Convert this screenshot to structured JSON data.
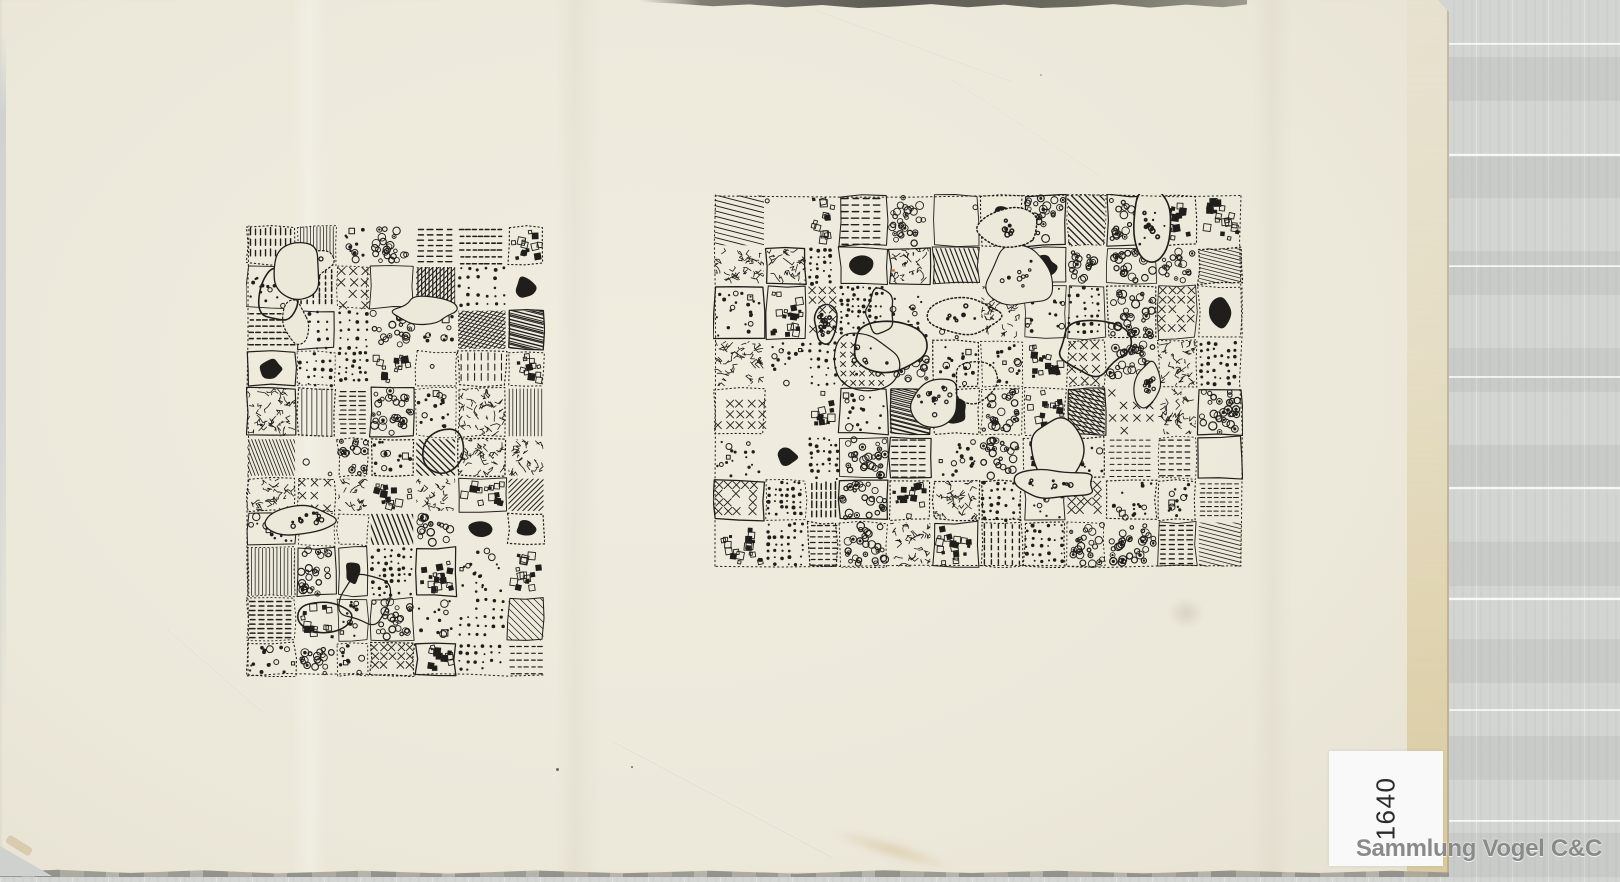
{
  "scan": {
    "background_color": "#d3d5d3",
    "background_band_light": "#e0e1e0",
    "background_band_dark": "#c8cac9",
    "background_line_color": "#f2f2f1",
    "paper_color": "#ece8da",
    "paper_edge_tan": "#d9c48e",
    "paper_right_edge_px": 1449,
    "paper_bottom_edge_px": 876
  },
  "label": {
    "number": "1640",
    "bg": "#f8f9f8",
    "text_color": "#2b2b2b",
    "rotation_deg": -90
  },
  "watermark": {
    "text": "Sammlung Vogel C&C",
    "color": "#8a8a8a"
  },
  "drawings": {
    "ink": "#201e1b",
    "paper_tone": "#ece8da",
    "description": "two dense abstract pen-and-ink doodle drawings with dots, rings, tiny squares, hatching and organic white blobs",
    "panels": [
      {
        "name": "left-drawing",
        "x": 246,
        "y": 225,
        "w": 299,
        "h": 452,
        "seed": 421,
        "cell": 43,
        "blob_div": 14500,
        "orientation": "portrait"
      },
      {
        "name": "right-drawing",
        "x": 713,
        "y": 194,
        "w": 530,
        "h": 374,
        "seed": 987,
        "cell": 45,
        "blob_div": 14000,
        "orientation": "landscape"
      }
    ],
    "motifs": [
      "dots",
      "rings",
      "squares",
      "hatch",
      "crosshatch",
      "scribble",
      "xmarks",
      "dashes",
      "blank",
      "solid",
      "mixed"
    ]
  }
}
